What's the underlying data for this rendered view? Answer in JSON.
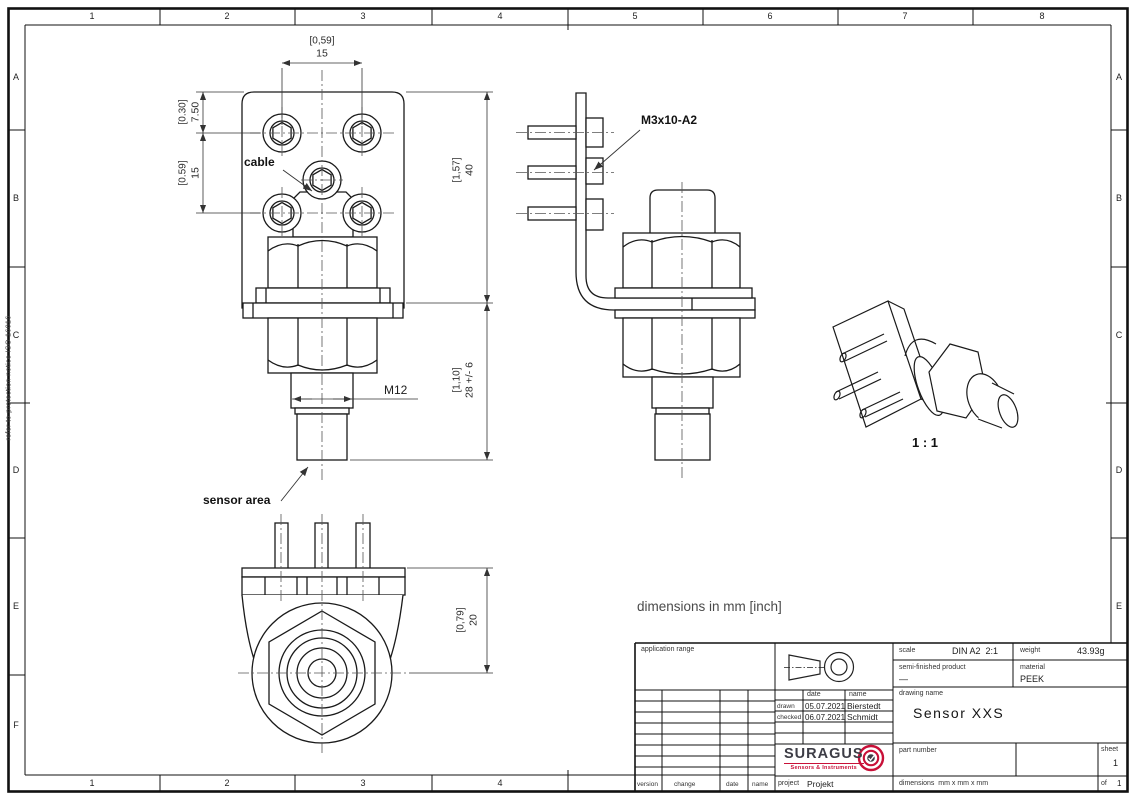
{
  "frame": {
    "grid_cols": [
      "1",
      "2",
      "3",
      "4",
      "5",
      "6",
      "7",
      "8"
    ],
    "grid_rows": [
      "A",
      "B",
      "C",
      "D",
      "E",
      "F"
    ],
    "protection_note": "refer to protection notice ISO 16016"
  },
  "annotations": {
    "cable": "cable",
    "sensor_area": "sensor area",
    "m12": "M12",
    "m3_screws": "M3x10-A2",
    "iso_scale": "1 : 1",
    "units_note": "dimensions in mm [inch]"
  },
  "dimensions": {
    "front_top": {
      "inch": "[0,59]",
      "mm": "15"
    },
    "front_left_upper": {
      "inch": "[0.30]",
      "mm": "7.50"
    },
    "front_left_lower": {
      "inch": "[0.59]",
      "mm": "15"
    },
    "front_right_upper": {
      "inch": "[1,57]",
      "mm": "40"
    },
    "front_right_lower": {
      "inch": "[1,10]",
      "mm": "28 +/- 6"
    },
    "bottom_right": {
      "inch": "[0,79]",
      "mm": "20"
    }
  },
  "title_block": {
    "application_range_label": "application range",
    "scale_label": "scale",
    "scale_value": "DIN A2  2:1",
    "weight_label": "weight",
    "weight_value": "43.93g",
    "semi_label": "semi-finished product",
    "semi_value": "—",
    "material_label": "material",
    "material_value": "PEEK",
    "drawing_name_label": "drawing name",
    "drawing_name": "Sensor XXS",
    "part_number_label": "part number",
    "sheet_label": "sheet",
    "sheet_value": "1",
    "of_label": "of",
    "of_value": "1",
    "dims_label": "dimensions  mm x mm x mm",
    "project_label": "project",
    "project_value": "Projekt",
    "date_header": "date",
    "name_header": "name",
    "rows": [
      {
        "role": "drawn",
        "date": "05.07.2021",
        "name": "Bierstedt"
      },
      {
        "role": "checked",
        "date": "06.07.2021",
        "name": "Schmidt"
      }
    ],
    "rev_labels": [
      "version",
      "change",
      "date",
      "name"
    ],
    "logo": {
      "text": "SURAGUS",
      "tagline": "Sensors & Instruments",
      "accent": "#c81038"
    }
  }
}
